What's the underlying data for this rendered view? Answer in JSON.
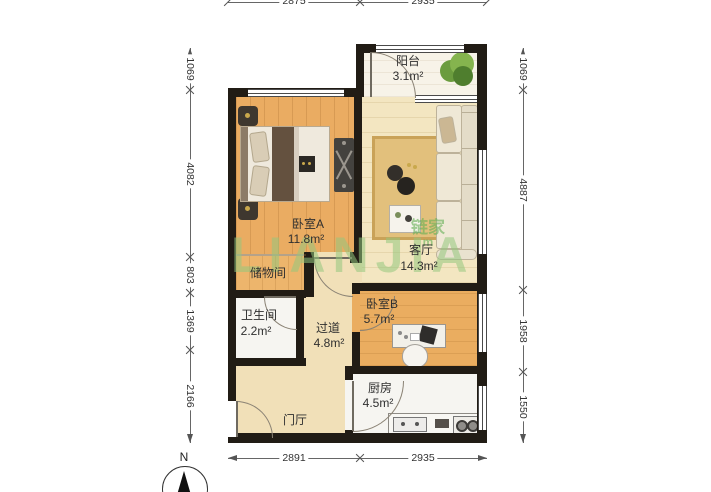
{
  "compass": {
    "label": "N"
  },
  "watermark": {
    "text": "LIANJIA",
    "logo_main": "链家",
    "logo_sub": "m"
  },
  "rooms": {
    "balcony": {
      "name": "阳台",
      "area": "3.1m²"
    },
    "bedroom_a": {
      "name": "卧室A",
      "area": "11.8m²"
    },
    "living": {
      "name": "客厅",
      "area": "14.3m²"
    },
    "storage": {
      "name": "储物间",
      "area": ""
    },
    "bathroom": {
      "name": "卫生间",
      "area": "2.2m²"
    },
    "corridor": {
      "name": "过道",
      "area": "4.8m²"
    },
    "bedroom_b": {
      "name": "卧室B",
      "area": "5.7m²"
    },
    "kitchen": {
      "name": "厨房",
      "area": "4.5m²"
    },
    "foyer": {
      "name": "门厅",
      "area": ""
    }
  },
  "dimensions": {
    "top": [
      "2875",
      "2935"
    ],
    "bottom": [
      "2891",
      "2935"
    ],
    "left": [
      "1069",
      "4082",
      "803",
      "1369",
      "2166"
    ],
    "right": [
      "1069",
      "4887",
      "1958",
      "1550"
    ]
  },
  "colors": {
    "wall": "#211c15",
    "wood_floor": "#eaac62",
    "cream_floor": "#f3e6c1",
    "watermark_green": "#94c77e"
  }
}
